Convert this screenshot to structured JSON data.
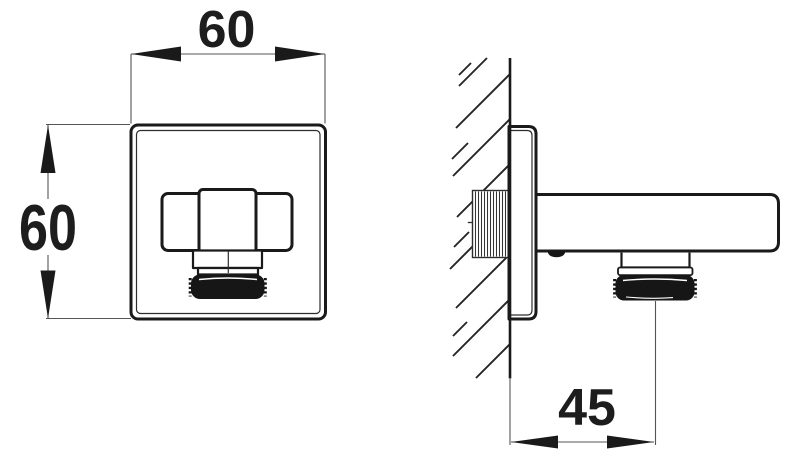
{
  "drawing": {
    "dim_front_width": "60",
    "dim_front_height": "60",
    "dim_wall_offset": "45"
  },
  "colors": {
    "background": "#ffffff",
    "outline": "#1a1a1a",
    "thin_line": "#555555",
    "thread_fill": "#161616"
  }
}
